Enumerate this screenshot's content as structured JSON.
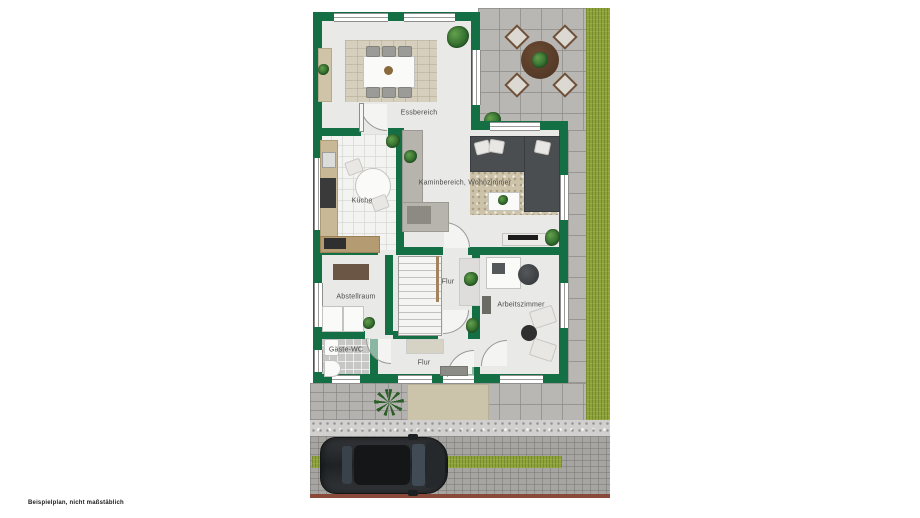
{
  "disclaimer": "Beispielplan, nicht maßstäblich",
  "floorplan": {
    "rooms": [
      {
        "id": "essbereich",
        "label": "Essbereich"
      },
      {
        "id": "kueche",
        "label": "Küche"
      },
      {
        "id": "wohnzimmer",
        "label": "Kaminbereich, Wohnzimmer"
      },
      {
        "id": "flur-treppe",
        "label": "Flur"
      },
      {
        "id": "abstellraum",
        "label": "Abstellraum"
      },
      {
        "id": "arbeitszimmer",
        "label": "Arbeitszimmer"
      },
      {
        "id": "gaeste-wc",
        "label": "Gäste-WC"
      },
      {
        "id": "flur-eingang",
        "label": "Flur"
      }
    ],
    "objects": [
      "dining-table",
      "sideboard",
      "kitchen-counter",
      "stove",
      "kitchen-table",
      "fireplace",
      "sofa",
      "coffee-table",
      "tv-board",
      "staircase",
      "washer",
      "dryer",
      "sink",
      "toilet",
      "desk",
      "office-chair",
      "armchairs",
      "patio-table",
      "patio-chairs",
      "car",
      "plants"
    ],
    "colors": {
      "wall": "#156f45",
      "floor": "#e9e9e7",
      "pavers": "#b8b7b4",
      "driveway": "#a6a5a2",
      "grass": "#8ea23c",
      "rug": "#d7cfbd",
      "curb": "#8a4a3a",
      "car": "#26292b"
    }
  }
}
